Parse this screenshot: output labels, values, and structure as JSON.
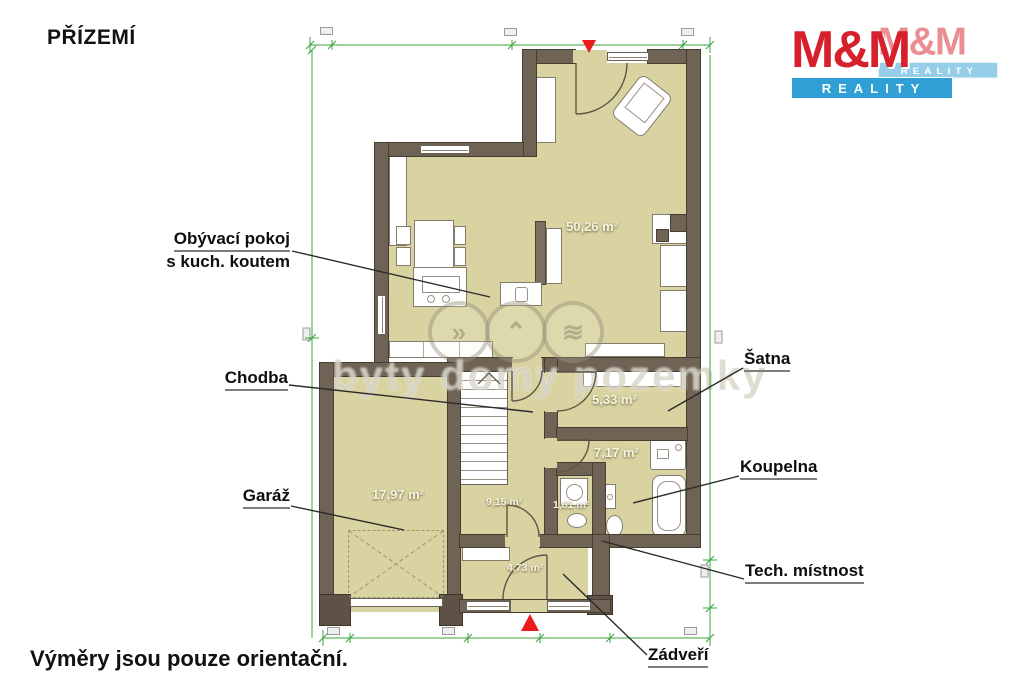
{
  "page": {
    "title": "PŘÍZEMÍ",
    "footer_note": "Výměry jsou pouze orientační."
  },
  "logo": {
    "brand": "M&M",
    "sub": "REALITY",
    "colors": {
      "red": "#d6202b",
      "blue": "#2f9fd6"
    }
  },
  "watermark": {
    "text": "byty domy pozemky"
  },
  "plan": {
    "rooms": [
      {
        "key": "living",
        "label_line1": "Obývací pokoj",
        "label_line2": "s kuch. koutem",
        "area": "50,26 m²"
      },
      {
        "key": "chodba",
        "label": "Chodba",
        "area": "9,15 m²"
      },
      {
        "key": "satna",
        "label": "Šatna",
        "area": "5,33 m²"
      },
      {
        "key": "koupelna",
        "label": "Koupelna",
        "area": "7,17 m²"
      },
      {
        "key": "garaz",
        "label": "Garáž",
        "area": "17,97 m²"
      },
      {
        "key": "tech",
        "label": "Tech. místnost",
        "area": "1,81 m²"
      },
      {
        "key": "zadveri",
        "label": "Zádveří",
        "area": "4,73 m²"
      }
    ],
    "colors": {
      "room_fill": "#d9d3a1",
      "wall": "#6e6355",
      "dimension_green": "#3aa43a",
      "entrance_red": "#ea1c1c"
    }
  }
}
